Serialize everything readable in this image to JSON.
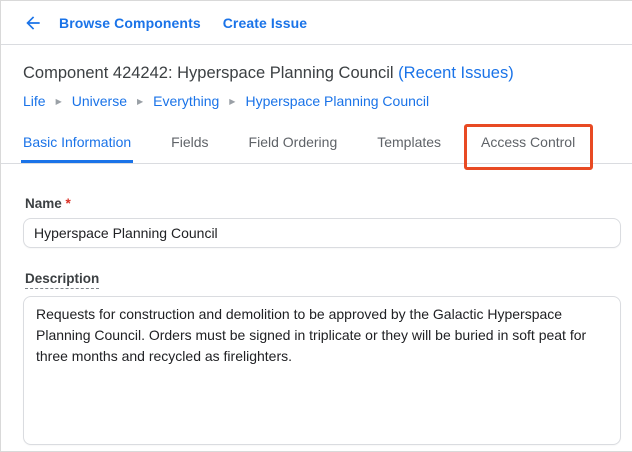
{
  "topbar": {
    "back_label": "back",
    "links": [
      {
        "label": "Browse Components"
      },
      {
        "label": "Create Issue"
      }
    ]
  },
  "header": {
    "title": "Component 424242: Hyperspace Planning Council",
    "recent_issues_link": "(Recent Issues)"
  },
  "breadcrumb": {
    "separator": "▶",
    "items": [
      "Life",
      "Universe",
      "Everything",
      "Hyperspace Planning Council"
    ]
  },
  "tabs": {
    "items": [
      {
        "label": "Basic Information",
        "active": true
      },
      {
        "label": "Fields",
        "active": false
      },
      {
        "label": "Field Ordering",
        "active": false
      },
      {
        "label": "Templates",
        "active": false
      },
      {
        "label": "Access Control",
        "active": false,
        "highlighted": true
      }
    ]
  },
  "annotation": {
    "target": "Access Control tab",
    "shape": "rectangle-outline",
    "color": "#e84a23"
  },
  "form": {
    "name": {
      "label": "Name",
      "required_marker": "*",
      "value": "Hyperspace Planning Council"
    },
    "description": {
      "label": "Description",
      "value": "Requests for construction and demolition to be approved by the Galactic Hyperspace Planning Council. Orders must be signed in triplicate or they will be buried in soft peat for three months and recycled as firelighters."
    }
  },
  "colors": {
    "link_blue": "#1a73e8",
    "annotation_red": "#e84a23",
    "border_gray": "#dadce0",
    "text_dark": "#3c4043",
    "tab_inactive": "#5f6368",
    "required_red": "#d93025"
  }
}
